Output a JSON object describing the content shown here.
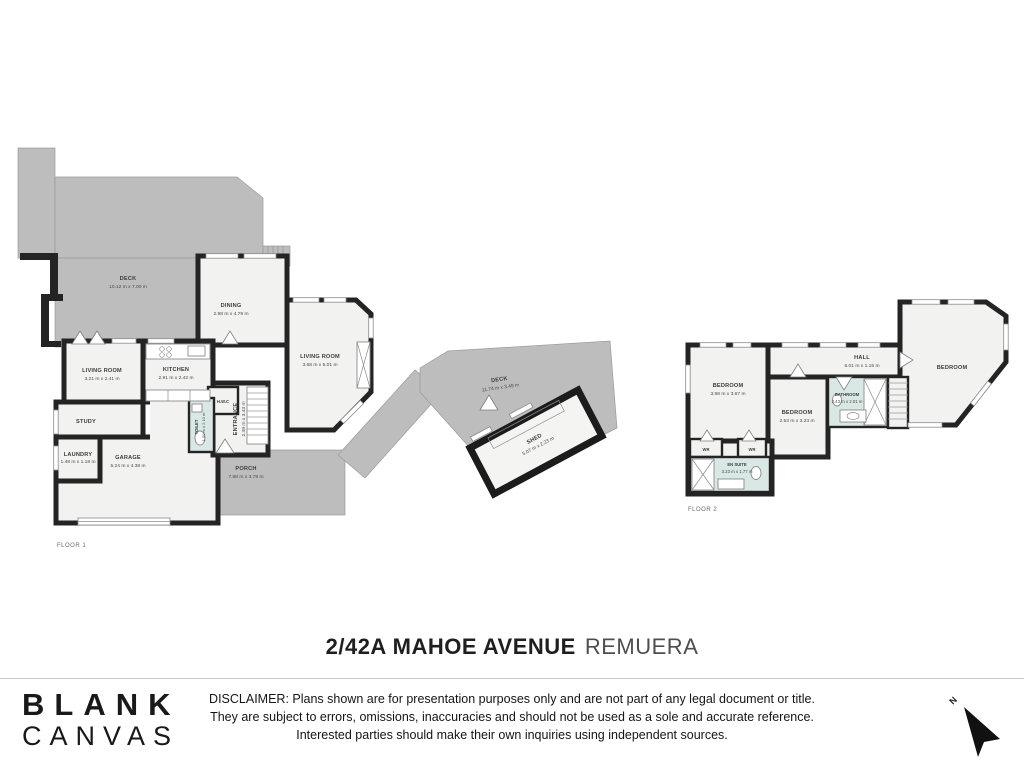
{
  "address": {
    "primary": "2/42A MAHOE AVENUE",
    "suffix": "REMUERA"
  },
  "logo": {
    "line1": "BLANK",
    "line2": "CANVAS"
  },
  "disclaimer": {
    "line1": "DISCLAIMER: Plans shown are for presentation purposes only and are not part of any legal document or title.",
    "line2": "They are subject to errors, omissions, inaccuracies and should not be used as a sole and accurate reference.",
    "line3": "Interested parties should make their own inquiries using independent sources."
  },
  "compass": {
    "label": "N"
  },
  "colors": {
    "deck_gray": "#bdbdbd",
    "wall_black": "#242424",
    "room_fill": "#f2f2f1",
    "wet_area_teal": "#d9e8e4"
  },
  "floor1": {
    "label": "FLOOR 1",
    "rooms": {
      "deck": {
        "name": "DECK",
        "dims": "10.12 m x 7.00 m"
      },
      "dining": {
        "name": "DINING",
        "dims": "2.98 m x 4.79 m"
      },
      "living_right": {
        "name": "LIVING ROOM",
        "dims": "3.68 m x 5.01 m"
      },
      "living_left": {
        "name": "LIVING ROOM",
        "dims": "3.21 m x 2.41 m"
      },
      "kitchen": {
        "name": "KITCHEN",
        "dims": "2.91 m x 2.42 m"
      },
      "hwc": {
        "name": "H.W.C"
      },
      "study": {
        "name": "STUDY"
      },
      "laundry": {
        "name": "LAUNDRY",
        "dims": "1.48 m x 1.18 m"
      },
      "garage": {
        "name": "GARAGE",
        "dims": "5.24 m x 4.38 m"
      },
      "toilet": {
        "name": "TOILET",
        "dims": "1.00 m x 2.10 m"
      },
      "entrance": {
        "name": "ENTRANCE",
        "dims": "2.49 m x 3.43 m"
      },
      "porch": {
        "name": "PORCH",
        "dims": "7.88 m x 3.78 m"
      }
    }
  },
  "outdoor": {
    "deck": {
      "name": "DECK",
      "dims": "11.74 m x 3.49 m"
    },
    "shed": {
      "name": "SHED",
      "dims": "5.07 m x 2.23 m"
    }
  },
  "floor2": {
    "label": "FLOOR 2",
    "rooms": {
      "bedroom_left": {
        "name": "BEDROOM",
        "dims": "3.98 m x 3.67 m"
      },
      "hall": {
        "name": "HALL",
        "dims": "6.01 m x 1.15 m"
      },
      "bedroom_mid": {
        "name": "BEDROOM",
        "dims": "2.53 m x 3.23 m"
      },
      "bathroom": {
        "name": "BATHROOM",
        "dims": "2.43 m x 2.01 m"
      },
      "bedroom_right": {
        "name": "BEDROOM"
      },
      "wr1": {
        "name": "WR"
      },
      "wr2": {
        "name": "WR"
      },
      "ensuite": {
        "name": "EN SUITE",
        "dims": "3.23 m x 1.77 m"
      }
    }
  }
}
